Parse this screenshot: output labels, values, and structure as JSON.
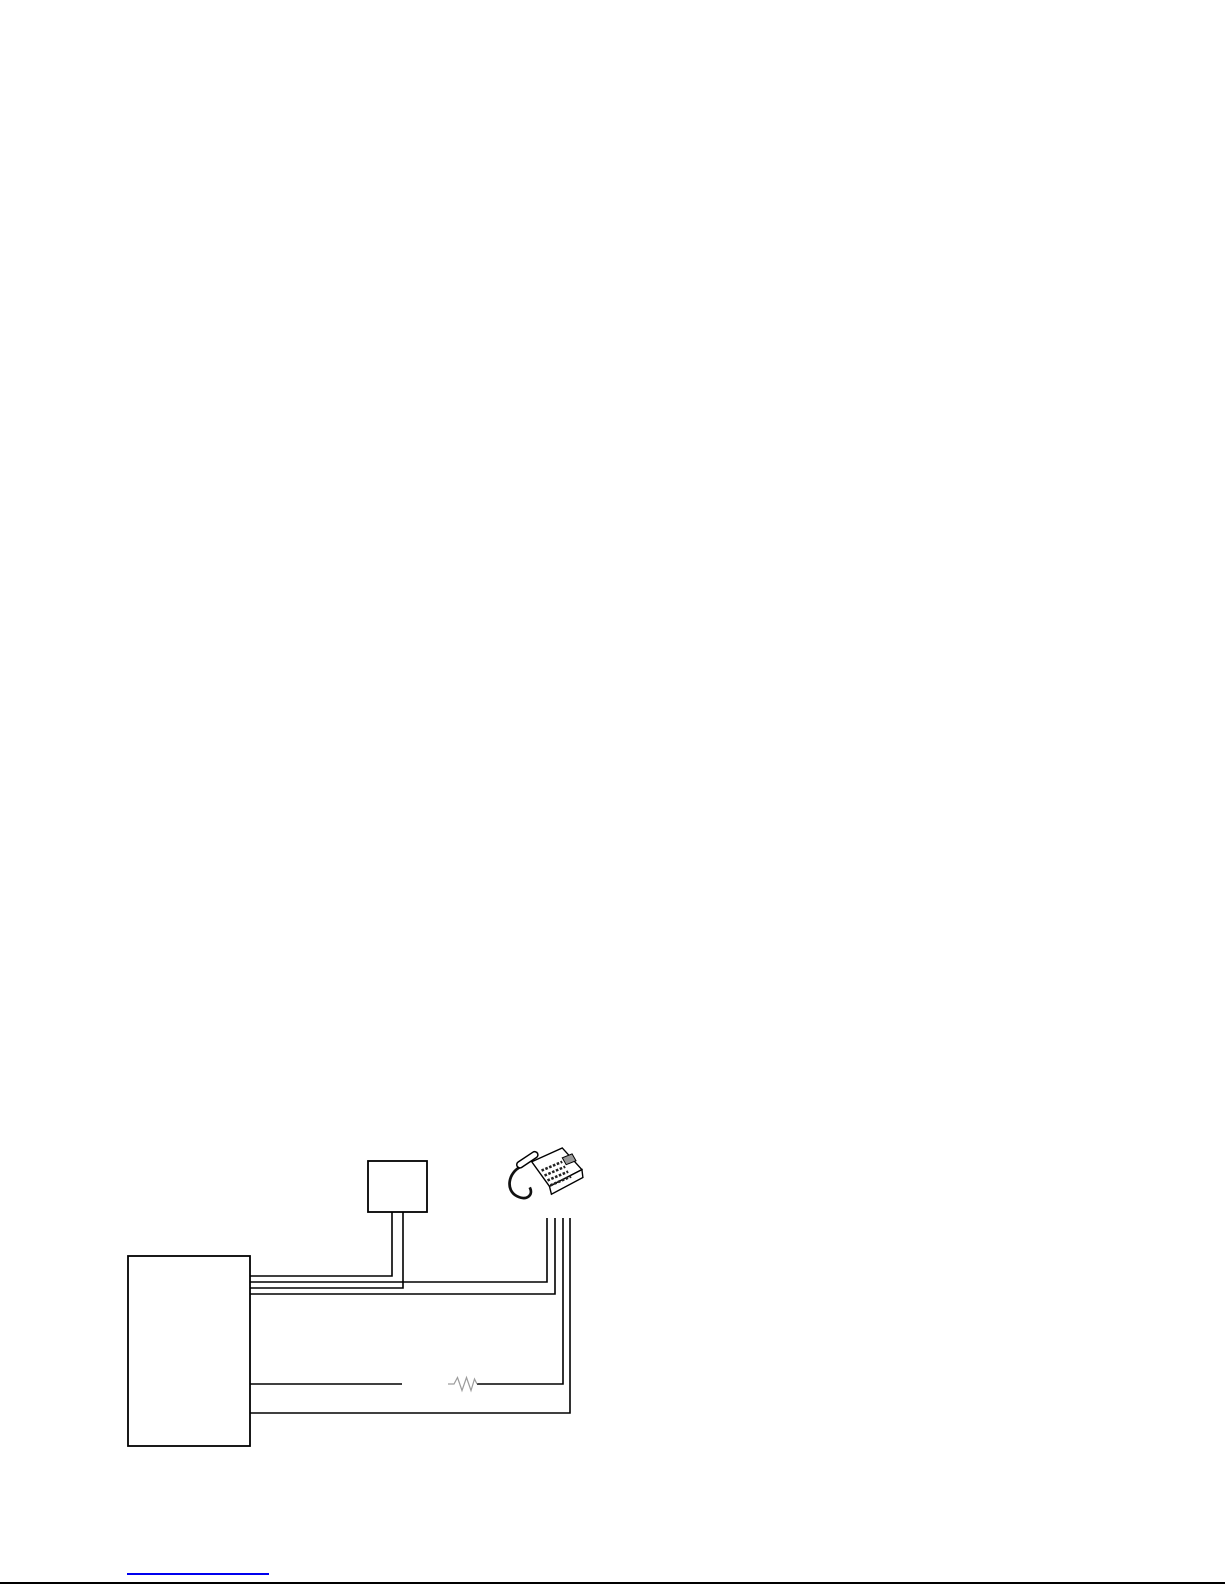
{
  "page": {
    "width": 1225,
    "height": 1585,
    "background": "#ffffff"
  },
  "diagram": {
    "wire_color": "#000000",
    "wire_thickness": 1.6,
    "box_stroke_color": "#000000",
    "box_fill_color": "#ffffff",
    "box_stroke_thickness": 1.8,
    "nodes": [
      {
        "name": "main-unit-box",
        "type": "box",
        "x": 128,
        "y": 1256,
        "width": 122,
        "height": 190
      },
      {
        "name": "junction-box",
        "type": "box",
        "x": 368,
        "y": 1161,
        "width": 59,
        "height": 51
      },
      {
        "name": "telephone",
        "type": "phone-icon",
        "x": 506,
        "y": 1146,
        "width": 81,
        "height": 61
      }
    ],
    "wires": [
      {
        "name": "wire-main-to-junction-left",
        "points": [
          [
            250,
            1276
          ],
          [
            392,
            1276
          ],
          [
            392,
            1212
          ]
        ]
      },
      {
        "name": "wire-main-to-phone-1",
        "points": [
          [
            250,
            1282
          ],
          [
            547,
            1282
          ],
          [
            547,
            1218
          ]
        ]
      },
      {
        "name": "wire-main-to-junction-right",
        "points": [
          [
            250,
            1288
          ],
          [
            403,
            1288
          ],
          [
            403,
            1212
          ]
        ]
      },
      {
        "name": "wire-main-to-phone-2",
        "points": [
          [
            250,
            1294
          ],
          [
            555,
            1294
          ],
          [
            555,
            1218
          ]
        ]
      },
      {
        "name": "wire-main-to-break",
        "points": [
          [
            250,
            1384
          ],
          [
            402,
            1384
          ]
        ]
      },
      {
        "name": "wire-resistor-to-phone",
        "points": [
          [
            477,
            1384
          ],
          [
            563,
            1384
          ],
          [
            563,
            1218
          ]
        ]
      },
      {
        "name": "wire-main-to-phone-bottom",
        "points": [
          [
            250,
            1413
          ],
          [
            570,
            1413
          ],
          [
            570,
            1218
          ]
        ]
      }
    ],
    "resistor": {
      "name": "resistor",
      "color": "#9c9c9c",
      "thickness": 1.2,
      "points": [
        [
          448,
          1384
        ],
        [
          454,
          1384
        ],
        [
          457.5,
          1377.5
        ],
        [
          462,
          1390.5
        ],
        [
          466.5,
          1377.5
        ],
        [
          471,
          1390.5
        ],
        [
          474.5,
          1379
        ],
        [
          477,
          1384
        ]
      ]
    }
  },
  "footer": {
    "link_underline": {
      "x1": 127,
      "x2": 269,
      "y": 1574,
      "color": "#0000ee",
      "thickness": 2
    },
    "divider": {
      "x1": 0,
      "x2": 1225,
      "y": 1583,
      "color": "#000000",
      "thickness": 2
    }
  }
}
